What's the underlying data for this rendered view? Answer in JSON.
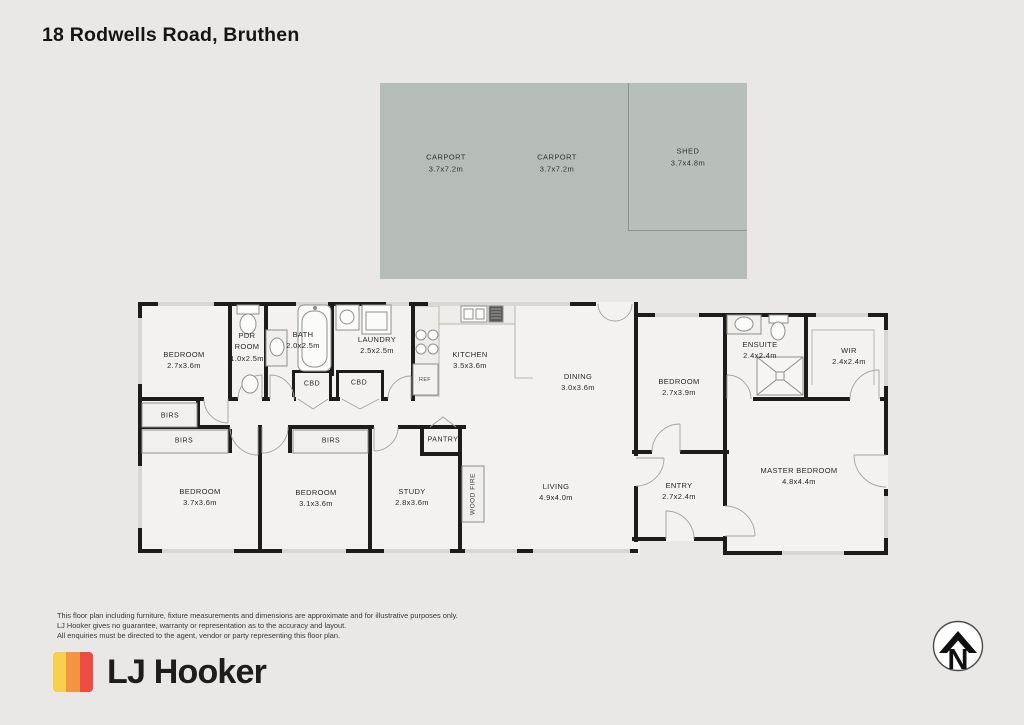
{
  "title": "18 Rodwells Road, Bruthen",
  "outbuildings": {
    "carport_left": {
      "name": "CARPORT",
      "size": "3.7x7.2m"
    },
    "carport_right": {
      "name": "CARPORT",
      "size": "3.7x7.2m"
    },
    "shed": {
      "name": "SHED",
      "size": "3.7x4.8m"
    }
  },
  "rooms": [
    {
      "name": "BEDROOM",
      "size": "2.7x3.6m"
    },
    {
      "name": "PDR ROOM",
      "size": "1.0x2.5m"
    },
    {
      "name": "BATH",
      "size": "2.0x2.5m"
    },
    {
      "name": "LAUNDRY",
      "size": "2.5x2.5m"
    },
    {
      "name": "KITCHEN",
      "size": "3.5x3.6m"
    },
    {
      "name": "DINING",
      "size": "3.0x3.6m"
    },
    {
      "name": "BEDROOM",
      "size": "2.7x3.9m"
    },
    {
      "name": "ENSUITE",
      "size": "2.4x2.4m"
    },
    {
      "name": "WIR",
      "size": "2.4x2.4m"
    },
    {
      "name": "BEDROOM",
      "size": "3.7x3.6m"
    },
    {
      "name": "BEDROOM",
      "size": "3.1x3.6m"
    },
    {
      "name": "STUDY",
      "size": "2.8x3.6m"
    },
    {
      "name": "LIVING",
      "size": "4.9x4.0m"
    },
    {
      "name": "ENTRY",
      "size": "2.7x2.4m"
    },
    {
      "name": "MASTER BEDROOM",
      "size": "4.8x4.4m"
    }
  ],
  "small_labels": [
    "CBD",
    "CBD",
    "REF",
    "BIRS",
    "BIRS",
    "BIRS",
    "PANTRY",
    "WOOD FIRE"
  ],
  "disclaimer": [
    "This floor plan including furniture, fixture measurements and dimensions are approximate and for illustrative purposes only.",
    "LJ Hooker gives no guarantee, warranty or representation as to the accuracy and layout.",
    "All enquiries must be directed to the agent, vendor or party representing this floor plan."
  ],
  "brand": {
    "name": "LJ Hooker",
    "stripe_colors": [
      "#F9D04B",
      "#F2953E",
      "#EE4B42"
    ]
  },
  "compass": {
    "label": "N"
  },
  "colors": {
    "carport_fill": "#b6bdb8",
    "wall": "#1c1c1c",
    "room_fill": "#f3f2f0",
    "background": "#e9e8e6"
  }
}
